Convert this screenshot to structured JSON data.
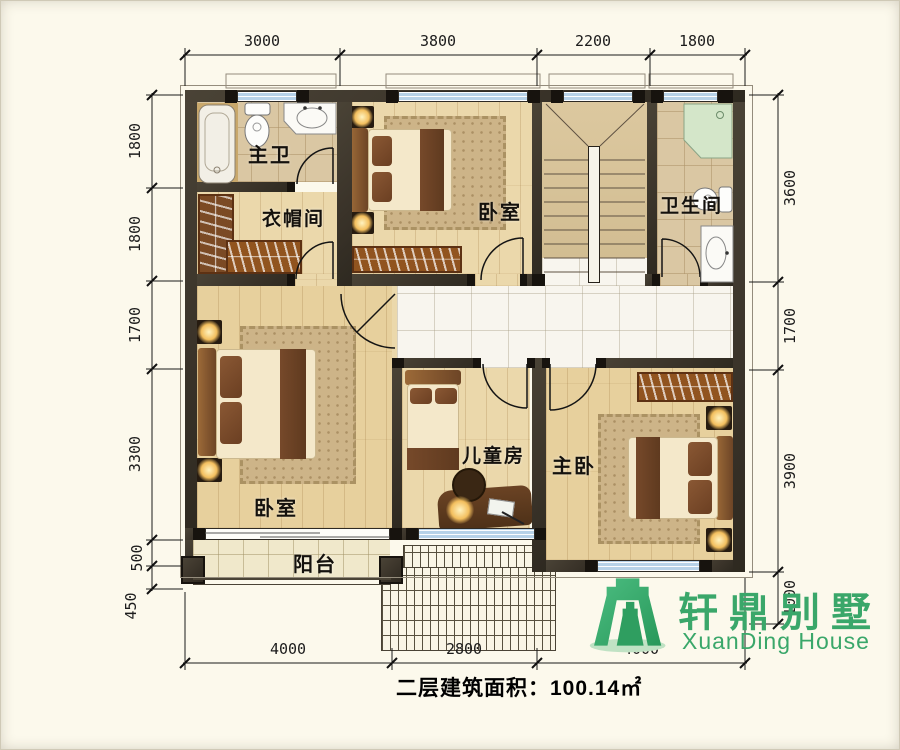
{
  "floorplan": {
    "area_text": "二层建筑面积：100.14㎡",
    "rooms": {
      "master_bath": "主卫",
      "cloakroom": "衣帽间",
      "bedroom_top": "卧室",
      "bathroom": "卫生间",
      "bedroom_left": "卧室",
      "kids_room": "儿童房",
      "master_bedroom": "主卧",
      "balcony": "阳台"
    },
    "dimensions": {
      "top": [
        "3000",
        "3800",
        "2200",
        "1800"
      ],
      "left": [
        "1800",
        "1800",
        "1700",
        "3300",
        "500",
        "450"
      ],
      "right": [
        "3600",
        "1700",
        "3900",
        "1000"
      ],
      "bottom": [
        "4000",
        "2800",
        "4000"
      ]
    },
    "logo": {
      "name_cn": "轩鼎别墅",
      "name_en": "XuanDing House"
    },
    "colors": {
      "logo_green": "#3aa76a",
      "wall": "#3f382d",
      "window_glass": "#b7d2e8",
      "floor_wood": "#ebd8ab"
    }
  }
}
